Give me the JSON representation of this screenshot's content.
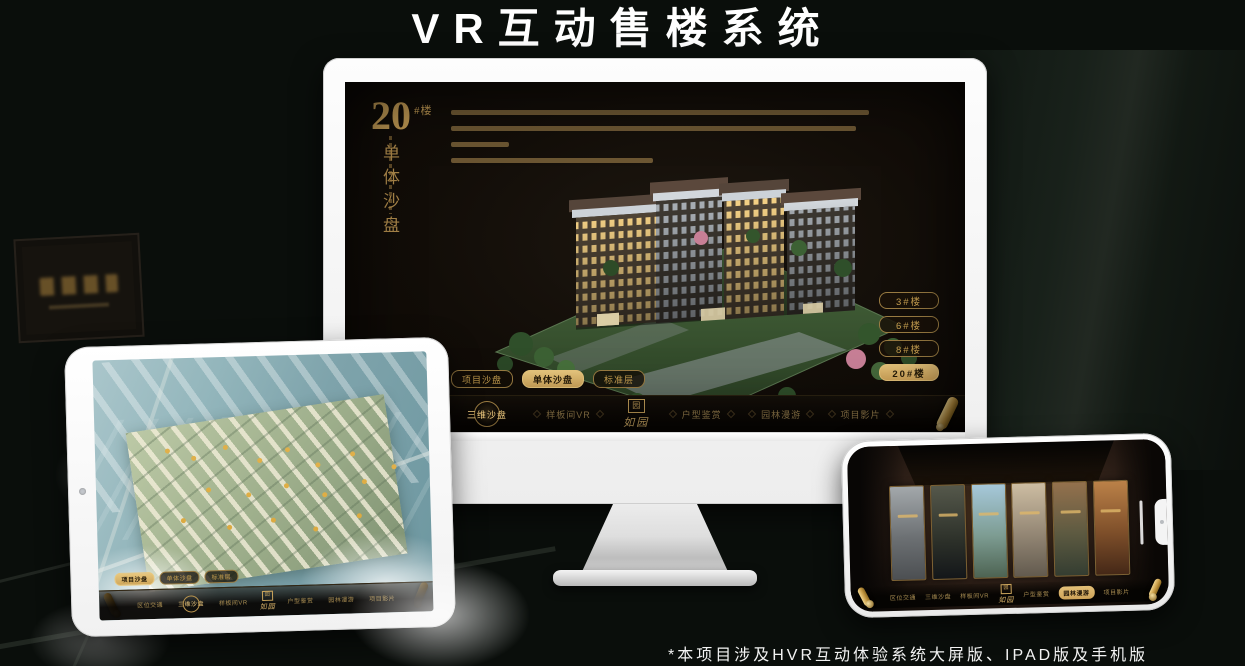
{
  "page": {
    "title": "VR互动售楼系统",
    "footnote": "*本项目涉及HVR互动体验系统大屏版、IPAD版及手机版"
  },
  "colors": {
    "gold": "#c9a35b",
    "gold_bright": "#e3c078",
    "screen_background": "#120d08"
  },
  "desktop": {
    "hero": {
      "number": "20",
      "suffix": "#楼",
      "subtitle": "单体沙盘"
    },
    "floor_buttons": [
      {
        "label": "3#楼",
        "active": false
      },
      {
        "label": "6#楼",
        "active": false
      },
      {
        "label": "8#楼",
        "active": false
      },
      {
        "label": "20#楼",
        "active": true
      }
    ],
    "view_tabs": [
      {
        "label": "项目沙盘",
        "active": false
      },
      {
        "label": "单体沙盘",
        "active": true
      },
      {
        "label": "标准层",
        "active": false
      }
    ],
    "menu": {
      "logo": "如园",
      "items": [
        {
          "label": "区位交通",
          "active": false
        },
        {
          "label": "三维沙盘",
          "active": true
        },
        {
          "label": "样板间VR",
          "active": false
        },
        {
          "label": "户型鉴赏",
          "active": false
        },
        {
          "label": "园林漫游",
          "active": false
        },
        {
          "label": "项目影片",
          "active": false
        }
      ]
    }
  },
  "tablet": {
    "view_tabs": [
      {
        "label": "项目沙盘",
        "active": true
      },
      {
        "label": "单体沙盘",
        "active": false
      },
      {
        "label": "标准层",
        "active": false
      }
    ],
    "menu": {
      "logo": "如园",
      "items": [
        {
          "label": "区位交通",
          "active": false
        },
        {
          "label": "三维沙盘",
          "active": true
        },
        {
          "label": "样板间VR",
          "active": false
        },
        {
          "label": "户型鉴赏",
          "active": false
        },
        {
          "label": "园林漫游",
          "active": false
        },
        {
          "label": "项目影片",
          "active": false
        }
      ]
    }
  },
  "phone": {
    "menu": {
      "logo": "如园",
      "items": [
        {
          "label": "区位交通",
          "active": false
        },
        {
          "label": "三维沙盘",
          "active": false
        },
        {
          "label": "样板间VR",
          "active": false
        },
        {
          "label": "户型鉴赏",
          "active": false
        },
        {
          "label": "园林漫游",
          "active": true
        },
        {
          "label": "项目影片",
          "active": false
        }
      ]
    }
  }
}
